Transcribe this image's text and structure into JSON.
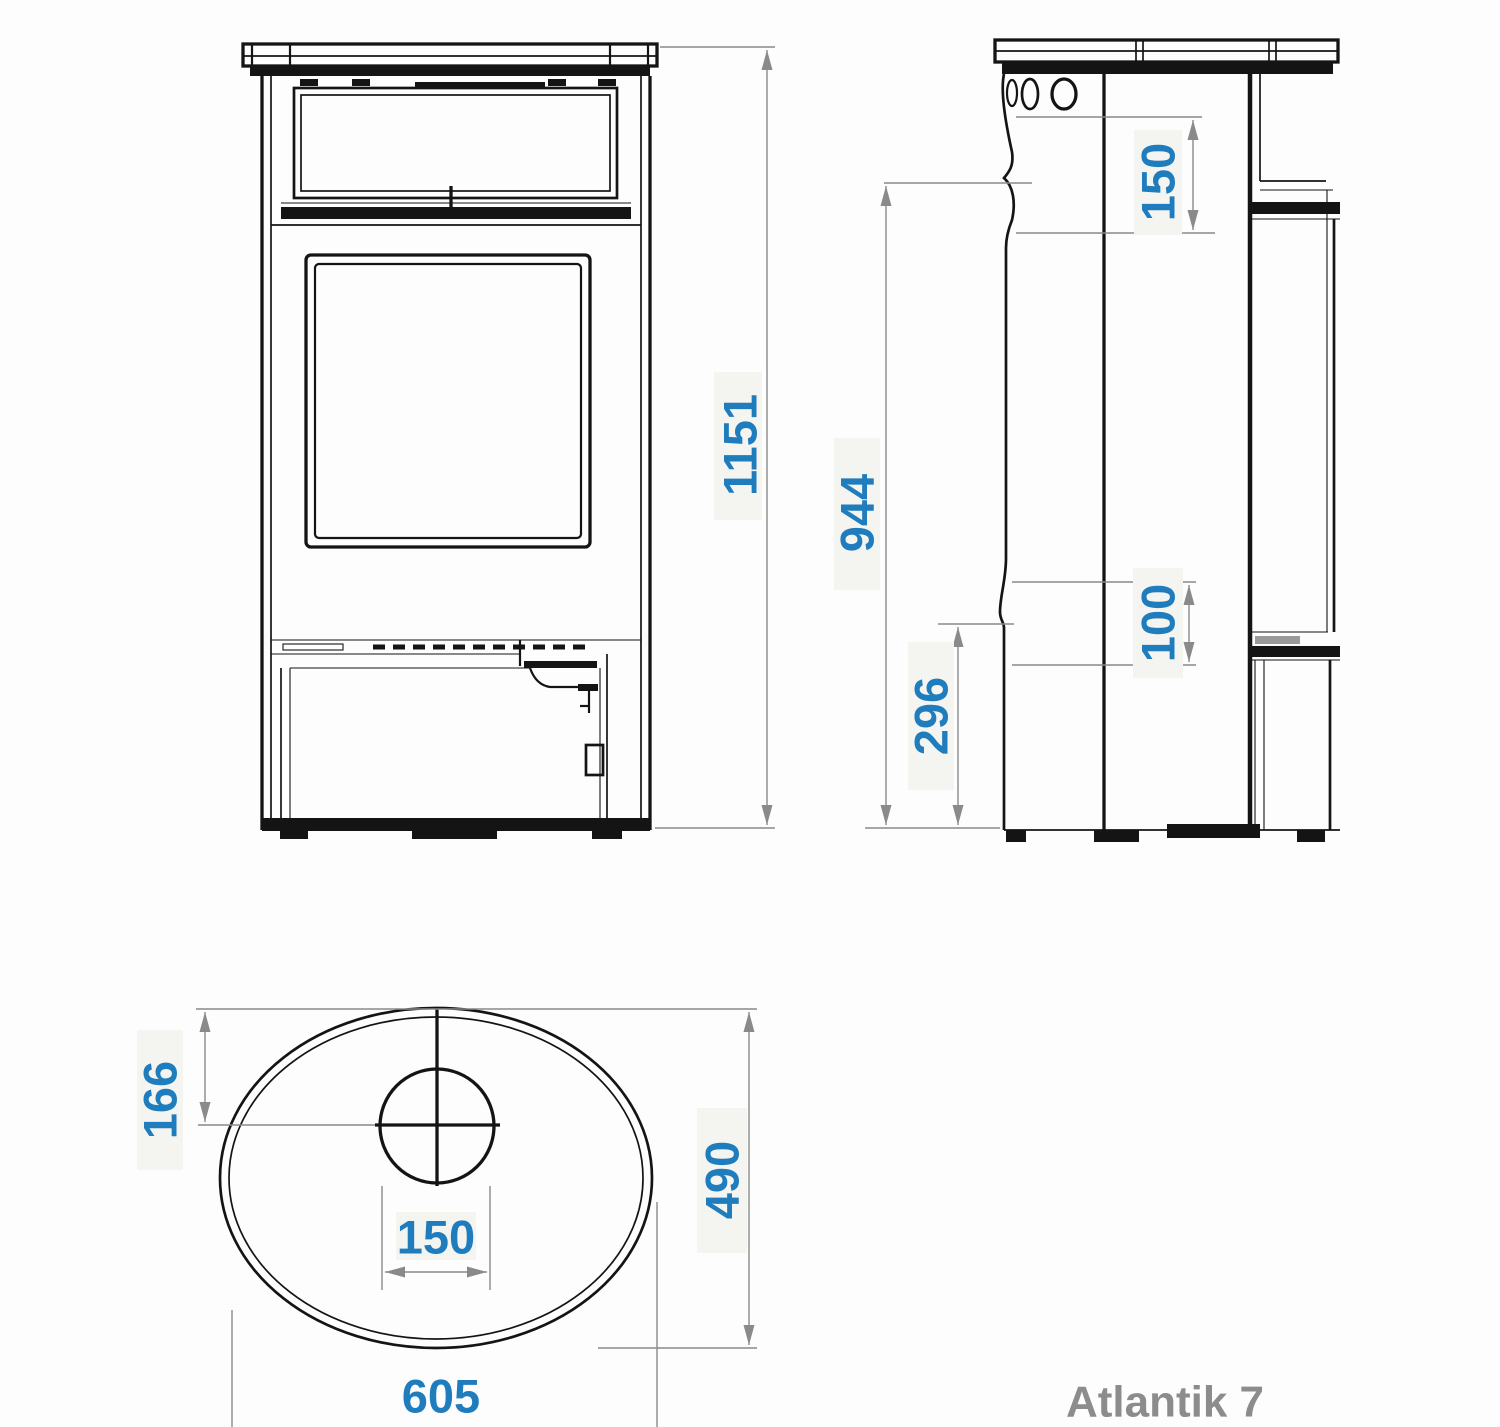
{
  "product": {
    "name": "Atlantik 7"
  },
  "colors": {
    "dimension_text": "#1f7cbd",
    "drawing_line": "#141414",
    "dimension_line": "#8a8a8a",
    "product_label": "#8c8c8c",
    "background": "#fdfdfd"
  },
  "views": {
    "front": {
      "name": "front-elevation",
      "dims": {
        "total_height": "1151"
      }
    },
    "side": {
      "name": "side-elevation",
      "dims": {
        "flue_collar_height": "150",
        "rear_outlet_height": "944",
        "outlet_offset": "100",
        "lower_section_height": "296"
      }
    },
    "top": {
      "name": "top-plan",
      "dims": {
        "flue_center_offset": "166",
        "depth": "490",
        "flue_diameter": "150",
        "width": "605"
      }
    }
  }
}
